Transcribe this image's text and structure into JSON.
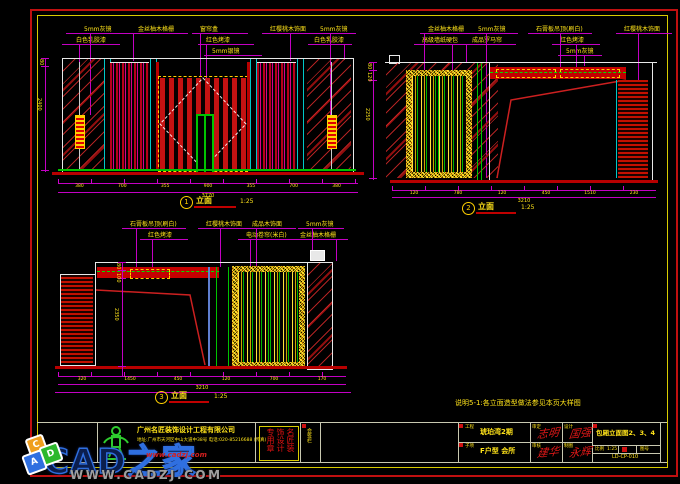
{
  "note": "说明5-1:各立面造型做法参见本页大样图",
  "views": [
    {
      "num": "1",
      "name": "立面",
      "scale": "1:25"
    },
    {
      "num": "2",
      "name": "立面",
      "scale": "1:25"
    },
    {
      "num": "3",
      "name": "立面",
      "scale": "1:25"
    }
  ],
  "d1": {
    "labels": [
      "5mm灰镜",
      "白色乳胶漆",
      "金丝柚木格栅",
      "窗帘盒",
      "红色烤漆",
      "5mm银镜",
      "红樱桃木饰面",
      "5mm灰镜",
      "白色乳胶漆"
    ],
    "dims": {
      "segments": [
        "380",
        "700",
        "355",
        "900",
        "355",
        "700",
        "380"
      ],
      "total": "3770",
      "left": [
        "80",
        "2400"
      ]
    }
  },
  "d2": {
    "labels": [
      "金丝柚木格栅",
      "高级墙纸硬包",
      "5mm灰镜",
      "成品罗马帘",
      "石膏板吊顶(刷白)",
      "红色烤漆",
      "5mm灰镜",
      "红樱桃木饰面"
    ],
    "dims": {
      "segments": [
        "120",
        "780",
        "120",
        "450",
        "1510",
        "230"
      ],
      "total": "3210",
      "left": [
        "80",
        "120",
        "2250"
      ]
    }
  },
  "d3": {
    "labels": [
      "石膏板吊顶(刷白)",
      "红色烤漆",
      "红樱桃木饰面",
      "成品木饰面",
      "电动卷帘(米白)",
      "5mm灰镜",
      "金丝柚木格栅"
    ],
    "dims": {
      "segments": [
        "320",
        "1450",
        "450",
        "120",
        "700",
        "170"
      ],
      "total": "3210",
      "left": [
        "80",
        "100",
        "2350"
      ]
    }
  },
  "titleblock": {
    "company_name": "广州名匠装饰设计工程有限公司",
    "company_info": "地址:广州市天河区中山大道中38号 电话:020-85216688 (传真)",
    "stamp": "名匠装饰设计专用章",
    "side_label": "会签栏",
    "project": {
      "label1": "工程",
      "value1": "琥珀湾2期",
      "label2": "子项",
      "value2": "F户型 会所"
    },
    "signs": [
      {
        "label": "审定",
        "name": "志明"
      },
      {
        "label": "审核",
        "name": "建华"
      },
      {
        "label": "设计",
        "name": "国强"
      },
      {
        "label": "制图",
        "name": "永辉"
      }
    ],
    "drawing_title": "包厢立面图2、3、4",
    "scale_label": "比例",
    "scale_value": "1:25",
    "sheet_label": "图号",
    "drawing_no": "LD-CP-010"
  },
  "watermark": {
    "brand": "CAD之家",
    "url_small": "www.cadzj.com",
    "url_big": "WWW.CADZJ.COM",
    "cube_letters": [
      "C",
      "D",
      "A"
    ]
  }
}
